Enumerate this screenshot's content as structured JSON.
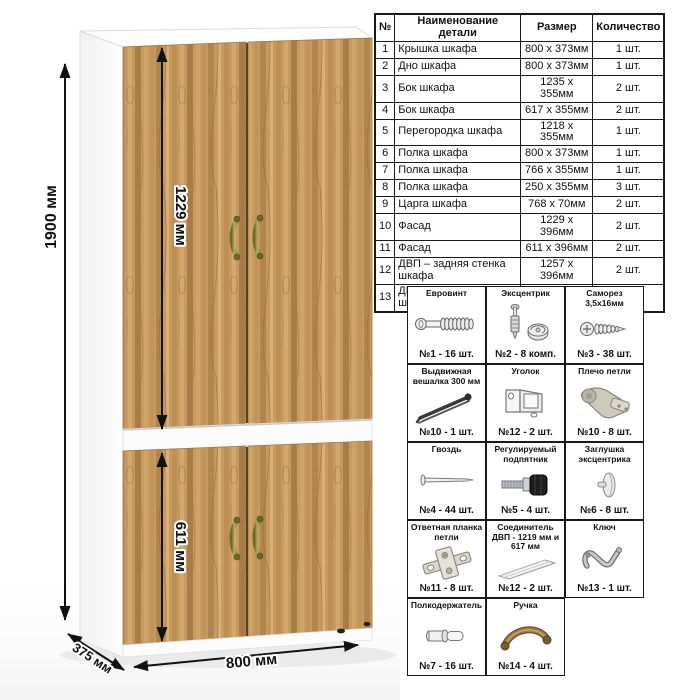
{
  "dims": {
    "height": "1900 мм",
    "upper_door": "1229 мм",
    "lower_door": "611 мм",
    "width": "800 мм",
    "depth": "375 мм"
  },
  "parts_table": {
    "headers": [
      "№",
      "Наименование детали",
      "Размер",
      "Количество"
    ],
    "rows": [
      {
        "num": "1",
        "name": "Крышка шкафа",
        "size": "800 х 373мм",
        "qty": "1 шт."
      },
      {
        "num": "2",
        "name": "Дно шкафа",
        "size": "800 х 373мм",
        "qty": "1 шт."
      },
      {
        "num": "3",
        "name": "Бок шкафа",
        "size": "1235 х 355мм",
        "qty": "2 шт."
      },
      {
        "num": "4",
        "name": "Бок шкафа",
        "size": "617 х 355мм",
        "qty": "2 шт."
      },
      {
        "num": "5",
        "name": "Перегородка шкафа",
        "size": "1218 х 355мм",
        "qty": "1 шт."
      },
      {
        "num": "6",
        "name": "Полка шкафа",
        "size": "800 х 373мм",
        "qty": "1 шт."
      },
      {
        "num": "7",
        "name": "Полка шкафа",
        "size": "766 х 355мм",
        "qty": "1 шт."
      },
      {
        "num": "8",
        "name": "Полка шкафа",
        "size": "250 х 355мм",
        "qty": "3 шт."
      },
      {
        "num": "9",
        "name": "Царга шкафа",
        "size": "768 х 70мм",
        "qty": "2 шт."
      },
      {
        "num": "10",
        "name": "Фасад",
        "size": "1229 х 396мм",
        "qty": "2 шт."
      },
      {
        "num": "11",
        "name": "Фасад",
        "size": "611 х 396мм",
        "qty": "2 шт."
      },
      {
        "num": "12",
        "name": "ДВП – задняя стенка шкафа",
        "size": "1257 х 396мм",
        "qty": "2 шт."
      },
      {
        "num": "13",
        "name": "ДВП – задняя стенка шкафа",
        "size": "639 х 396мм",
        "qty": "2 шт."
      }
    ]
  },
  "hardware": {
    "items": [
      {
        "title": "Евровинт",
        "qty": "№1 - 16 шт.",
        "icon": "euro-screw-icon"
      },
      {
        "title": "Эксцентрик",
        "qty": "№2 - 8 комп.",
        "icon": "cam-lock-icon"
      },
      {
        "title": "Саморез 3,5х16мм",
        "qty": "№3 - 38 шт.",
        "icon": "self-tapping-screw-icon"
      },
      {
        "title": "Выдвижная вешалка 300 мм",
        "qty": "№10 - 1 шт.",
        "icon": "pull-out-hanger-icon"
      },
      {
        "title": "Уголок",
        "qty": "№12 - 2 шт.",
        "icon": "corner-bracket-icon"
      },
      {
        "title": "Плечо петли",
        "qty": "№10 - 8 шт.",
        "icon": "hinge-arm-icon"
      },
      {
        "title": "Гвоздь",
        "qty": "№4 - 44 шт.",
        "icon": "nail-icon"
      },
      {
        "title": "Регулируемый подпятник",
        "qty": "№5 - 4 шт.",
        "icon": "adjustable-foot-icon"
      },
      {
        "title": "Заглушка эксцентрика",
        "qty": "№6 - 8 шт.",
        "icon": "cam-cover-icon"
      },
      {
        "title": "Ответная планка петли",
        "qty": "№11 - 8 шт.",
        "icon": "hinge-plate-icon"
      },
      {
        "title": "Соединитель ДВП - 1219 мм и 617 мм",
        "qty": "№12 - 2 шт.",
        "icon": "hdf-connector-icon"
      },
      {
        "title": "Ключ",
        "qty": "№13 - 1 шт.",
        "icon": "hex-key-icon"
      },
      {
        "title": "Полкодержатель",
        "qty": "№7 - 16 шт.",
        "icon": "shelf-pin-icon"
      },
      {
        "title": "Ручка",
        "qty": "№14 - 4 шт.",
        "icon": "handle-icon"
      }
    ]
  },
  "colors": {
    "wood": "#c79a5f",
    "handle_brass": "#8f8a3e",
    "line": "#1a1a1a"
  }
}
